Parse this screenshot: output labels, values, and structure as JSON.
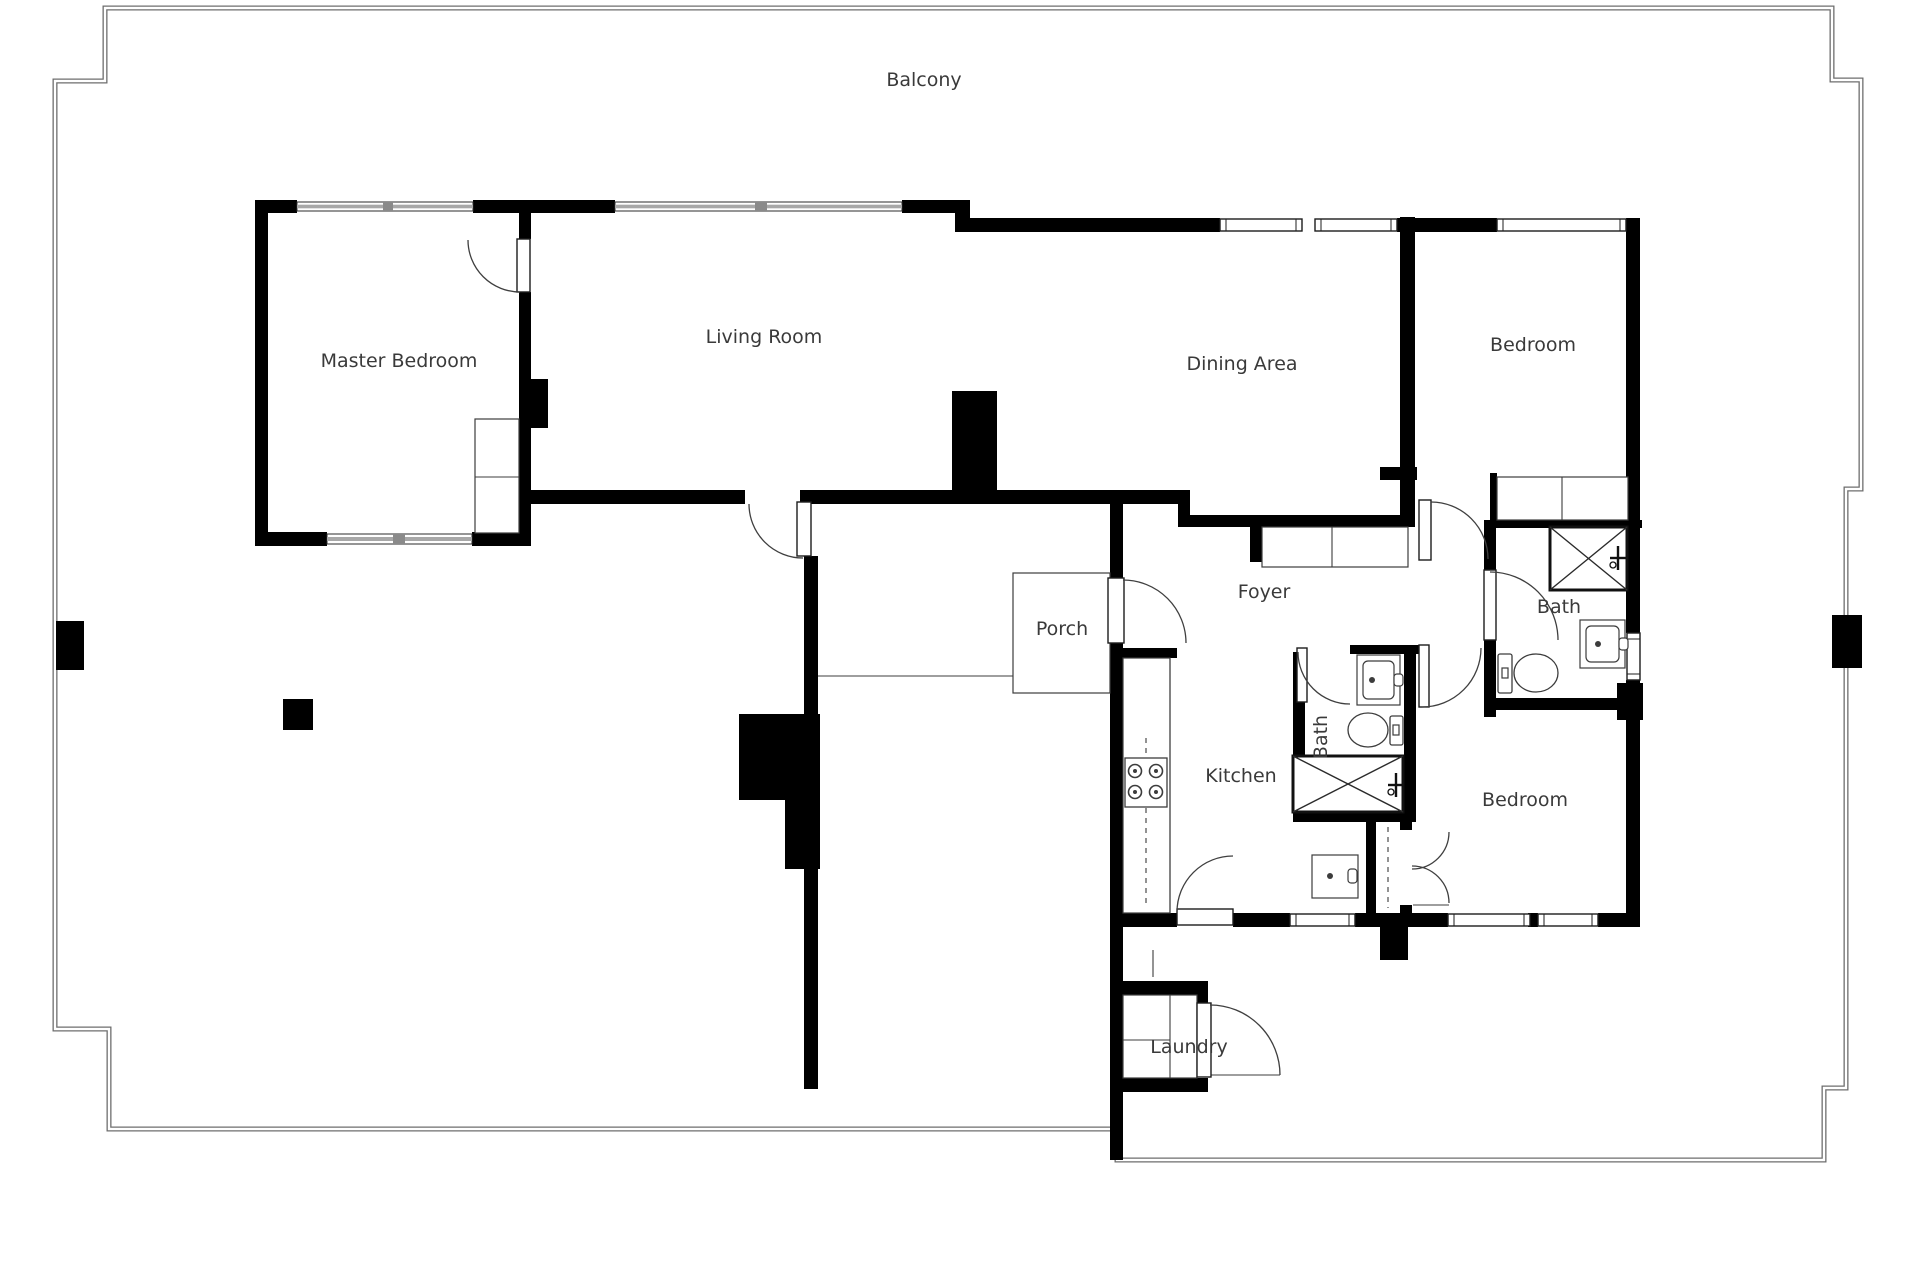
{
  "meta": {
    "background": "#ffffff",
    "wall_color": "#000000",
    "boundary_color": "#6e6e6e",
    "fixture_line_color": "#3c3c3c",
    "window_gray": "#a8a8a8",
    "text_color": "#3a3a3a",
    "font_size": 19
  },
  "labels": [
    {
      "name": "balcony",
      "text": "Balcony",
      "x": 924,
      "y": 86,
      "rotate": 0
    },
    {
      "name": "master-bedroom",
      "text": "Master Bedroom",
      "x": 399,
      "y": 367,
      "rotate": 0
    },
    {
      "name": "living-room",
      "text": "Living Room",
      "x": 764,
      "y": 343,
      "rotate": 0
    },
    {
      "name": "dining-area",
      "text": "Dining Area",
      "x": 1242,
      "y": 370,
      "rotate": 0
    },
    {
      "name": "bedroom-top",
      "text": "Bedroom",
      "x": 1533,
      "y": 351,
      "rotate": 0
    },
    {
      "name": "foyer",
      "text": "Foyer",
      "x": 1264,
      "y": 598,
      "rotate": 0
    },
    {
      "name": "bath-top-right",
      "text": "Bath",
      "x": 1559,
      "y": 613,
      "rotate": 0
    },
    {
      "name": "porch",
      "text": "Porch",
      "x": 1062,
      "y": 635,
      "rotate": 0
    },
    {
      "name": "bath-middle",
      "text": "Bath",
      "x": 1327,
      "y": 737,
      "rotate": -90
    },
    {
      "name": "kitchen",
      "text": "Kitchen",
      "x": 1241,
      "y": 782,
      "rotate": 0
    },
    {
      "name": "bedroom-bottom",
      "text": "Bedroom",
      "x": 1525,
      "y": 806,
      "rotate": 0
    },
    {
      "name": "laundry",
      "text": "Laundry",
      "x": 1189,
      "y": 1053,
      "rotate": 0
    }
  ],
  "boundary_path": "M 105,8 H 1832 V 80 H 1861 V 489 H 1846 V 1088 H 1824 V 1160 H 1117 V 1129 H 109 V 1029 H 55 V 81 H 105 Z",
  "columns": [
    [
      56,
      621,
      28,
      49
    ],
    [
      1832,
      615,
      30,
      53
    ],
    [
      283,
      699,
      30,
      31
    ]
  ],
  "walls": [
    [
      255,
      200,
      42,
      13
    ],
    [
      473,
      200,
      142,
      13
    ],
    [
      902,
      200,
      68,
      13
    ],
    [
      955,
      200,
      15,
      32
    ],
    [
      970,
      218,
      250,
      14
    ],
    [
      1397,
      218,
      100,
      14
    ],
    [
      255,
      200,
      13,
      346
    ],
    [
      255,
      532,
      72,
      14
    ],
    [
      472,
      532,
      59,
      14
    ],
    [
      519,
      200,
      12,
      39
    ],
    [
      519,
      292,
      12,
      87
    ],
    [
      519,
      379,
      29,
      49
    ],
    [
      519,
      428,
      12,
      105
    ],
    [
      519,
      490,
      226,
      14
    ],
    [
      800,
      490,
      390,
      14
    ],
    [
      952,
      391,
      45,
      99
    ],
    [
      1178,
      490,
      12,
      37
    ],
    [
      1178,
      515,
      237,
      12
    ],
    [
      1250,
      527,
      12,
      35
    ],
    [
      1110,
      504,
      13,
      74
    ],
    [
      1110,
      643,
      13,
      517
    ],
    [
      804,
      556,
      14,
      158
    ],
    [
      739,
      714,
      81,
      86
    ],
    [
      785,
      800,
      35,
      69
    ],
    [
      804,
      869,
      14,
      220
    ],
    [
      1123,
      648,
      54,
      10
    ],
    [
      1123,
      913,
      54,
      14
    ],
    [
      1233,
      913,
      57,
      14
    ],
    [
      1355,
      913,
      53,
      14
    ],
    [
      1380,
      927,
      28,
      33
    ],
    [
      1408,
      913,
      40,
      14
    ],
    [
      1528,
      913,
      10,
      14
    ],
    [
      1598,
      913,
      42,
      14
    ],
    [
      1350,
      645,
      72,
      9
    ],
    [
      1293,
      652,
      12,
      170
    ],
    [
      1293,
      812,
      115,
      10
    ],
    [
      1404,
      645,
      12,
      177
    ],
    [
      1366,
      822,
      10,
      91
    ],
    [
      1400,
      822,
      12,
      8
    ],
    [
      1400,
      905,
      12,
      22
    ],
    [
      1400,
      217,
      15,
      300
    ],
    [
      1380,
      467,
      37,
      13
    ],
    [
      1490,
      473,
      7,
      54
    ],
    [
      1484,
      520,
      158,
      8
    ],
    [
      1484,
      528,
      12,
      42
    ],
    [
      1484,
      640,
      12,
      77
    ],
    [
      1484,
      698,
      159,
      12
    ],
    [
      1617,
      683,
      26,
      37
    ],
    [
      1626,
      218,
      14,
      415
    ],
    [
      1626,
      680,
      14,
      247
    ],
    [
      1120,
      981,
      88,
      14
    ],
    [
      1120,
      1078,
      88,
      14
    ],
    [
      1197,
      995,
      11,
      10
    ]
  ],
  "gray_windows": [
    [
      297,
      202,
      176,
      9
    ],
    [
      615,
      202,
      287,
      9
    ],
    [
      327,
      534,
      145,
      10
    ]
  ],
  "gray_window_ticks": [
    [
      383,
      202,
      10,
      9
    ],
    [
      755,
      202,
      12,
      9
    ],
    [
      393,
      534,
      12,
      10
    ]
  ],
  "white_windows": [
    [
      1220,
      219,
      82,
      12
    ],
    [
      1315,
      219,
      82,
      12
    ],
    [
      1497,
      219,
      129,
      12
    ],
    [
      1290,
      914,
      65,
      12
    ],
    [
      1448,
      914,
      82,
      12
    ],
    [
      1538,
      914,
      60,
      12
    ],
    [
      1627,
      633,
      13,
      47
    ]
  ],
  "door_leaves": [
    [
      517,
      239,
      13,
      53
    ],
    [
      797,
      502,
      14,
      54
    ],
    [
      1108,
      578,
      16,
      65
    ],
    [
      1177,
      909,
      56,
      16
    ],
    [
      1297,
      648,
      10,
      54
    ],
    [
      1419,
      500,
      12,
      60
    ],
    [
      1419,
      645,
      10,
      62
    ],
    [
      1484,
      570,
      12,
      70
    ],
    [
      1197,
      1003,
      14,
      74
    ]
  ],
  "door_arcs": [
    "M 468,240 A 52 52 0 0 0 520,292",
    "M 749,504 A 54 54 0 0 0 803,558",
    "M 1123,580 A 63 63 0 0 1 1186,643",
    "M 1177,912 A 56 56 0 0 1 1233,856",
    "M 1298,652 A 52 52 0 0 0 1350,704",
    "M 1431,502 A 57 57 0 0 1 1488,559",
    "M 1481,648 A 59 59 0 0 1 1422,707",
    "M 1490,572 A 68 68 0 0 1 1558,640",
    "M 1210,1005 A 70 70 0 0 1 1280,1075",
    "M 1449,832 A 37 37 0 0 1 1412,869",
    "M 1412,866 A 37 37 0 0 1 1449,903"
  ],
  "thin_rects": [
    {
      "name": "porch-slab",
      "r": [
        1013,
        573,
        97,
        120
      ]
    },
    {
      "name": "master-closet",
      "r": [
        475,
        419,
        44,
        114
      ]
    },
    {
      "name": "bedroom-top-closet",
      "r": [
        1497,
        477,
        131,
        43
      ]
    },
    {
      "name": "foyer-closet",
      "r": [
        1262,
        527,
        146,
        40
      ]
    },
    {
      "name": "kitchen-counter",
      "r": [
        1123,
        658,
        47,
        255
      ]
    },
    {
      "name": "laundry-machines",
      "r": [
        1123,
        995,
        74,
        83
      ]
    },
    {
      "name": "nook-sink",
      "r": [
        1312,
        855,
        46,
        43
      ]
    },
    {
      "name": "bath-tr-sink",
      "r": [
        1580,
        620,
        45,
        48
      ]
    },
    {
      "name": "bath-mid-sink",
      "r": [
        1357,
        655,
        43,
        50
      ]
    }
  ],
  "thin_lines": [
    [
      818,
      676,
      1013,
      676
    ],
    [
      1210,
      1075,
      1280,
      1075
    ],
    [
      1413,
      905,
      1449,
      905
    ],
    [
      475,
      477,
      519,
      477
    ],
    [
      1562,
      477,
      1562,
      520
    ],
    [
      1332,
      527,
      1332,
      567
    ],
    [
      1170,
      658,
      1170,
      913
    ],
    [
      1170,
      995,
      1170,
      1078
    ],
    [
      1123,
      1040,
      1170,
      1040
    ],
    [
      1153,
      950,
      1153,
      977
    ]
  ],
  "dashed_lines": [
    [
      1146,
      738,
      1146,
      908
    ],
    [
      1388,
      827,
      1388,
      908
    ]
  ],
  "showers": [
    {
      "r": [
        1293,
        756,
        110,
        56
      ],
      "cross": [
        1396,
        785
      ]
    },
    {
      "r": [
        1550,
        527,
        77,
        63
      ],
      "cross": [
        1618,
        558
      ]
    }
  ],
  "toilets": [
    {
      "tank": [
        1390,
        716,
        13,
        29
      ],
      "bowl": [
        1368,
        730,
        20,
        17
      ],
      "dot": [
        1396,
        730
      ]
    },
    {
      "tank": [
        1498,
        654,
        14,
        39
      ],
      "bowl": [
        1536,
        673,
        22,
        19
      ],
      "dot": [
        1505,
        673
      ]
    }
  ],
  "sink_details": [
    {
      "inner": [
        1363,
        661,
        31,
        38
      ],
      "dot": [
        1372,
        680
      ],
      "tap": [
        1394,
        674,
        9,
        12
      ]
    },
    {
      "inner": [
        1586,
        626,
        33,
        36
      ],
      "dot": [
        1598,
        644
      ],
      "tap": [
        1619,
        638,
        9,
        12
      ]
    },
    {
      "inner": null,
      "dot": [
        1330,
        876
      ],
      "tap": [
        1348,
        869,
        9,
        14
      ]
    }
  ],
  "stove": {
    "r": [
      1125,
      758,
      42,
      49
    ],
    "burners": [
      [
        1135,
        771
      ],
      [
        1156,
        771
      ],
      [
        1135,
        792
      ],
      [
        1156,
        792
      ]
    ],
    "burner_radius": 6.5
  }
}
